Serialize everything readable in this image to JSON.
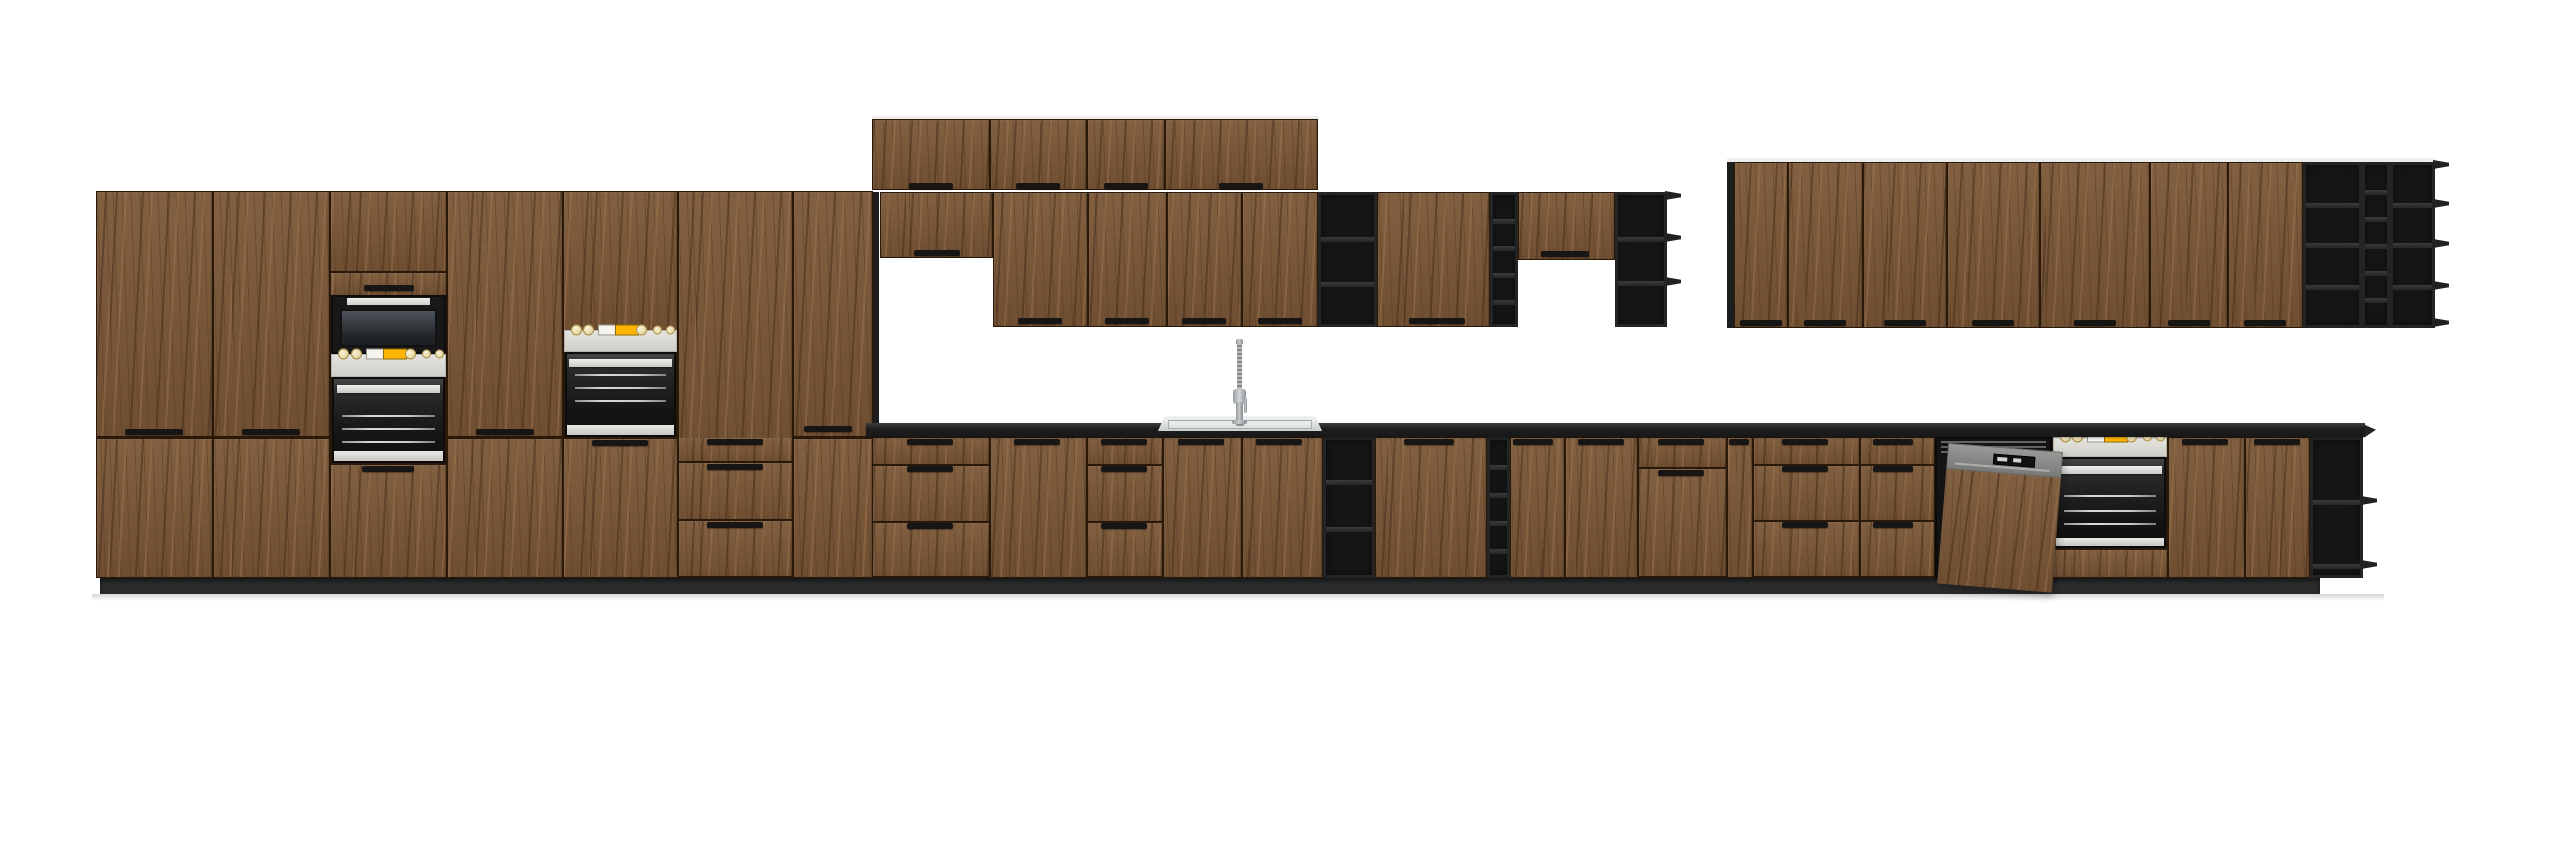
{
  "scene": {
    "kind": "kitchen-cabinet-set-product-render",
    "palette": {
      "background": "#ffffff",
      "wood": "#7b5737",
      "wood_gap": "#2a1808",
      "black_frame": "#242424",
      "black_cavity": "#161616",
      "countertop": "#1e1e1e",
      "plinth": "#2c2c2c",
      "appliance_panel_gray": "#d8d7d3",
      "appliance_display_yellow": "#ffb400",
      "dishwasher_gray": "#8d8f90",
      "steel": "#c9cdce",
      "floor_shadow": "#d6d6d6"
    },
    "modules": [
      {
        "k": "lightline",
        "name": "wall-cabinet-top-edge",
        "x": 872,
        "y": 116,
        "w": 446,
        "h": 4
      },
      {
        "k": "lightline",
        "name": "wall-cabinet-top-edge",
        "x": 1727,
        "y": 158,
        "w": 708,
        "h": 4
      },
      {
        "k": "strip",
        "name": "tall-block-side-panel",
        "x": 866,
        "y": 192,
        "w": 13,
        "h": 231
      },
      {
        "k": "strip",
        "name": "right-run-side-panel",
        "x": 1727,
        "y": 162,
        "w": 7,
        "h": 166
      },
      {
        "k": "tall",
        "name": "tall-pantry-cabinet",
        "x": 96,
        "y": 191,
        "w": 117,
        "h": 387,
        "split": 437
      },
      {
        "k": "tall",
        "name": "tall-pantry-cabinet",
        "x": 213,
        "y": 191,
        "w": 117,
        "h": 387,
        "split": 437
      },
      {
        "k": "tower_mw",
        "name": "oven-microwave-tower",
        "x": 330,
        "y": 191,
        "w": 117,
        "h": 387
      },
      {
        "k": "tall",
        "name": "tall-pantry-cabinet",
        "x": 447,
        "y": 191,
        "w": 116,
        "h": 387,
        "split": 437
      },
      {
        "k": "tower_oven",
        "name": "oven-tower",
        "x": 563,
        "y": 191,
        "w": 115,
        "h": 387,
        "below": "door"
      },
      {
        "k": "tower_oven",
        "name": "oven-tower",
        "x": 678,
        "y": 191,
        "w": 115,
        "h": 387,
        "below": "drawers",
        "splits": [
          462,
          520
        ]
      },
      {
        "k": "tall",
        "name": "tall-pantry-cabinet",
        "x": 793,
        "y": 191,
        "w": 80,
        "h": 387,
        "split": 437
      },
      {
        "k": "door",
        "name": "top-wall-cabinet",
        "x": 872,
        "y": 119,
        "w": 118,
        "h": 71
      },
      {
        "k": "door",
        "name": "top-wall-cabinet",
        "x": 990,
        "y": 119,
        "w": 97,
        "h": 71
      },
      {
        "k": "door",
        "name": "top-wall-cabinet",
        "x": 1087,
        "y": 119,
        "w": 78,
        "h": 71
      },
      {
        "k": "door",
        "name": "top-wall-cabinet",
        "x": 1165,
        "y": 119,
        "w": 153,
        "h": 71
      },
      {
        "k": "door",
        "name": "short-wall-cabinet",
        "x": 880,
        "y": 192,
        "w": 113,
        "h": 66
      },
      {
        "k": "door",
        "name": "wall-cabinet",
        "x": 993,
        "y": 192,
        "w": 95,
        "h": 135
      },
      {
        "k": "door",
        "name": "wall-cabinet",
        "x": 1088,
        "y": 192,
        "w": 79,
        "h": 135
      },
      {
        "k": "door",
        "name": "wall-cabinet",
        "x": 1167,
        "y": 192,
        "w": 75,
        "h": 135
      },
      {
        "k": "door",
        "name": "wall-cabinet",
        "x": 1242,
        "y": 192,
        "w": 76,
        "h": 135
      },
      {
        "k": "shelves",
        "name": "open-shelf-unit",
        "x": 1318,
        "y": 192,
        "w": 59,
        "h": 135,
        "rows": [
          237,
          282
        ]
      },
      {
        "k": "door",
        "name": "wall-cabinet",
        "x": 1377,
        "y": 192,
        "w": 113,
        "h": 135
      },
      {
        "k": "shelves",
        "name": "wine-shelf-column",
        "x": 1490,
        "y": 192,
        "w": 28,
        "h": 135,
        "rows": [
          219,
          246,
          273,
          300
        ]
      },
      {
        "k": "door",
        "name": "short-wall-cabinet",
        "x": 1518,
        "y": 192,
        "w": 97,
        "h": 68
      },
      {
        "k": "shelves",
        "name": "open-shelf-unit",
        "x": 1615,
        "y": 192,
        "w": 52,
        "h": 135,
        "rows": [
          237,
          281
        ],
        "noses": [
          195,
          237,
          281
        ]
      },
      {
        "k": "door",
        "name": "wall-cabinet",
        "x": 1734,
        "y": 162,
        "w": 54,
        "h": 166
      },
      {
        "k": "door",
        "name": "wall-cabinet",
        "x": 1788,
        "y": 162,
        "w": 75,
        "h": 166
      },
      {
        "k": "door",
        "name": "wall-cabinet",
        "x": 1863,
        "y": 162,
        "w": 84,
        "h": 166
      },
      {
        "k": "door",
        "name": "wall-cabinet",
        "x": 1947,
        "y": 162,
        "w": 93,
        "h": 166
      },
      {
        "k": "door",
        "name": "wall-cabinet",
        "x": 2040,
        "y": 162,
        "w": 110,
        "h": 166
      },
      {
        "k": "door",
        "name": "wall-cabinet",
        "x": 2150,
        "y": 162,
        "w": 78,
        "h": 166
      },
      {
        "k": "door",
        "name": "wall-cabinet",
        "x": 2228,
        "y": 162,
        "w": 75,
        "h": 166
      },
      {
        "k": "shelves",
        "name": "open-shelf-end-unit",
        "x": 2303,
        "y": 162,
        "w": 59,
        "h": 166,
        "rows": [
          203,
          243,
          285
        ]
      },
      {
        "k": "shelves",
        "name": "wine-shelf-column",
        "x": 2362,
        "y": 162,
        "w": 28,
        "h": 166,
        "rows": [
          190,
          217,
          244,
          271,
          298
        ]
      },
      {
        "k": "shelves",
        "name": "open-shelf-end-unit",
        "x": 2390,
        "y": 162,
        "w": 45,
        "h": 166,
        "rows": [
          203,
          243,
          285
        ],
        "noses": [
          164,
          203,
          243,
          285,
          322
        ]
      },
      {
        "k": "drawers",
        "name": "base-drawer-unit",
        "x": 872,
        "y": 437,
        "w": 118,
        "h": 141,
        "splits": [
          465,
          522
        ]
      },
      {
        "k": "door",
        "name": "base-cabinet",
        "x": 990,
        "y": 437,
        "w": 97,
        "h": 141
      },
      {
        "k": "drawers",
        "name": "base-drawer-unit",
        "x": 1087,
        "y": 437,
        "w": 76,
        "h": 141,
        "splits": [
          465,
          522
        ]
      },
      {
        "k": "door",
        "name": "sink-base-cabinet",
        "x": 1163,
        "y": 437,
        "w": 79,
        "h": 141
      },
      {
        "k": "door",
        "name": "sink-base-cabinet",
        "x": 1242,
        "y": 437,
        "w": 81,
        "h": 141
      },
      {
        "k": "shelves",
        "name": "open-shelf-unit",
        "x": 1323,
        "y": 437,
        "w": 52,
        "h": 141,
        "rows": [
          480,
          527
        ]
      },
      {
        "k": "door",
        "name": "base-cabinet",
        "x": 1375,
        "y": 437,
        "w": 112,
        "h": 141
      },
      {
        "k": "shelves",
        "name": "wine-shelf-column",
        "x": 1487,
        "y": 437,
        "w": 23,
        "h": 141,
        "rows": [
          465,
          493,
          521,
          549
        ]
      },
      {
        "k": "door",
        "name": "base-cabinet",
        "x": 1510,
        "y": 437,
        "w": 55,
        "h": 141
      },
      {
        "k": "door",
        "name": "base-cabinet",
        "x": 1565,
        "y": 437,
        "w": 73,
        "h": 141
      },
      {
        "k": "drawers",
        "name": "base-drawer-door-unit",
        "x": 1638,
        "y": 437,
        "w": 89,
        "h": 141,
        "splits": [
          468
        ]
      },
      {
        "k": "door",
        "name": "base-filler-cabinet",
        "x": 1727,
        "y": 437,
        "w": 26,
        "h": 141
      },
      {
        "k": "drawers",
        "name": "base-drawer-unit",
        "x": 1753,
        "y": 437,
        "w": 107,
        "h": 141,
        "splits": [
          465,
          521
        ]
      },
      {
        "k": "drawers",
        "name": "base-drawer-unit",
        "x": 1860,
        "y": 437,
        "w": 75,
        "h": 141,
        "splits": [
          465,
          521
        ]
      },
      {
        "k": "dwcav",
        "name": "dishwasher-cavity",
        "x": 1935,
        "y": 437,
        "w": 117,
        "h": 141
      },
      {
        "k": "oven_base",
        "name": "built-in-oven-base-unit",
        "x": 2052,
        "y": 437,
        "w": 116,
        "h": 141
      },
      {
        "k": "door",
        "name": "base-cabinet",
        "x": 2168,
        "y": 437,
        "w": 77,
        "h": 141
      },
      {
        "k": "door",
        "name": "base-cabinet",
        "x": 2245,
        "y": 437,
        "w": 65,
        "h": 141
      },
      {
        "k": "shelves",
        "name": "open-shelf-end-unit",
        "x": 2310,
        "y": 437,
        "w": 53,
        "h": 141,
        "rows": [
          500,
          564
        ],
        "noses": [
          500,
          564
        ]
      },
      {
        "k": "counter",
        "name": "countertop",
        "x": 866,
        "y": 423,
        "w": 1499,
        "h": 14
      },
      {
        "k": "cnose",
        "name": "countertop-end-nose",
        "x": 2365,
        "y": 425,
        "w": 11,
        "h": 12
      },
      {
        "k": "sink",
        "name": "kitchen-sink",
        "x": 1158,
        "y": 416,
        "w": 164,
        "h": 15
      },
      {
        "k": "faucet",
        "name": "kitchen-faucet",
        "x": 1228,
        "y": 343
      },
      {
        "k": "plinth",
        "name": "plinth",
        "x": 100,
        "y": 578,
        "w": 2220,
        "h": 16
      },
      {
        "k": "fshadow",
        "name": "floor-shadow",
        "x": 92,
        "y": 594,
        "w": 2292,
        "h": 7
      },
      {
        "k": "dwdoor",
        "name": "dishwasher-open-door",
        "x": 1948,
        "y": 452,
        "w": 115,
        "h": 141,
        "rot": 4.5
      }
    ],
    "handles": [
      [
        125,
        429,
        58
      ],
      [
        242,
        429,
        58
      ],
      [
        476,
        429,
        58
      ],
      [
        804,
        426,
        48
      ],
      [
        364,
        285,
        50
      ],
      [
        362,
        466,
        52
      ],
      [
        592,
        440,
        56
      ],
      [
        707,
        439,
        56
      ],
      [
        707,
        464,
        56
      ],
      [
        707,
        522,
        56
      ],
      [
        909,
        183,
        44
      ],
      [
        1016,
        183,
        44
      ],
      [
        1104,
        183,
        44
      ],
      [
        1219,
        183,
        44
      ],
      [
        914,
        250,
        46
      ],
      [
        1018,
        318,
        44
      ],
      [
        1105,
        318,
        44
      ],
      [
        1182,
        318,
        44
      ],
      [
        1258,
        318,
        44
      ],
      [
        1409,
        318,
        56
      ],
      [
        1541,
        251,
        48
      ],
      [
        1740,
        320,
        42
      ],
      [
        1804,
        320,
        42
      ],
      [
        1884,
        320,
        42
      ],
      [
        1972,
        320,
        42
      ],
      [
        2074,
        320,
        42
      ],
      [
        2168,
        320,
        42
      ],
      [
        2244,
        320,
        42
      ],
      [
        907,
        439,
        46
      ],
      [
        907,
        466,
        46
      ],
      [
        907,
        523,
        46
      ],
      [
        1014,
        439,
        46
      ],
      [
        1101,
        439,
        46
      ],
      [
        1101,
        466,
        46
      ],
      [
        1101,
        523,
        46
      ],
      [
        1178,
        439,
        46
      ],
      [
        1256,
        439,
        46
      ],
      [
        1404,
        439,
        50
      ],
      [
        1513,
        439,
        40
      ],
      [
        1578,
        439,
        46
      ],
      [
        1658,
        439,
        46
      ],
      [
        1658,
        470,
        46
      ],
      [
        1729,
        439,
        20
      ],
      [
        1782,
        439,
        46
      ],
      [
        1782,
        466,
        46
      ],
      [
        1782,
        522,
        46
      ],
      [
        1873,
        439,
        40
      ],
      [
        1873,
        466,
        40
      ],
      [
        1873,
        522,
        40
      ],
      [
        2182,
        439,
        46
      ],
      [
        2254,
        439,
        46
      ]
    ]
  }
}
